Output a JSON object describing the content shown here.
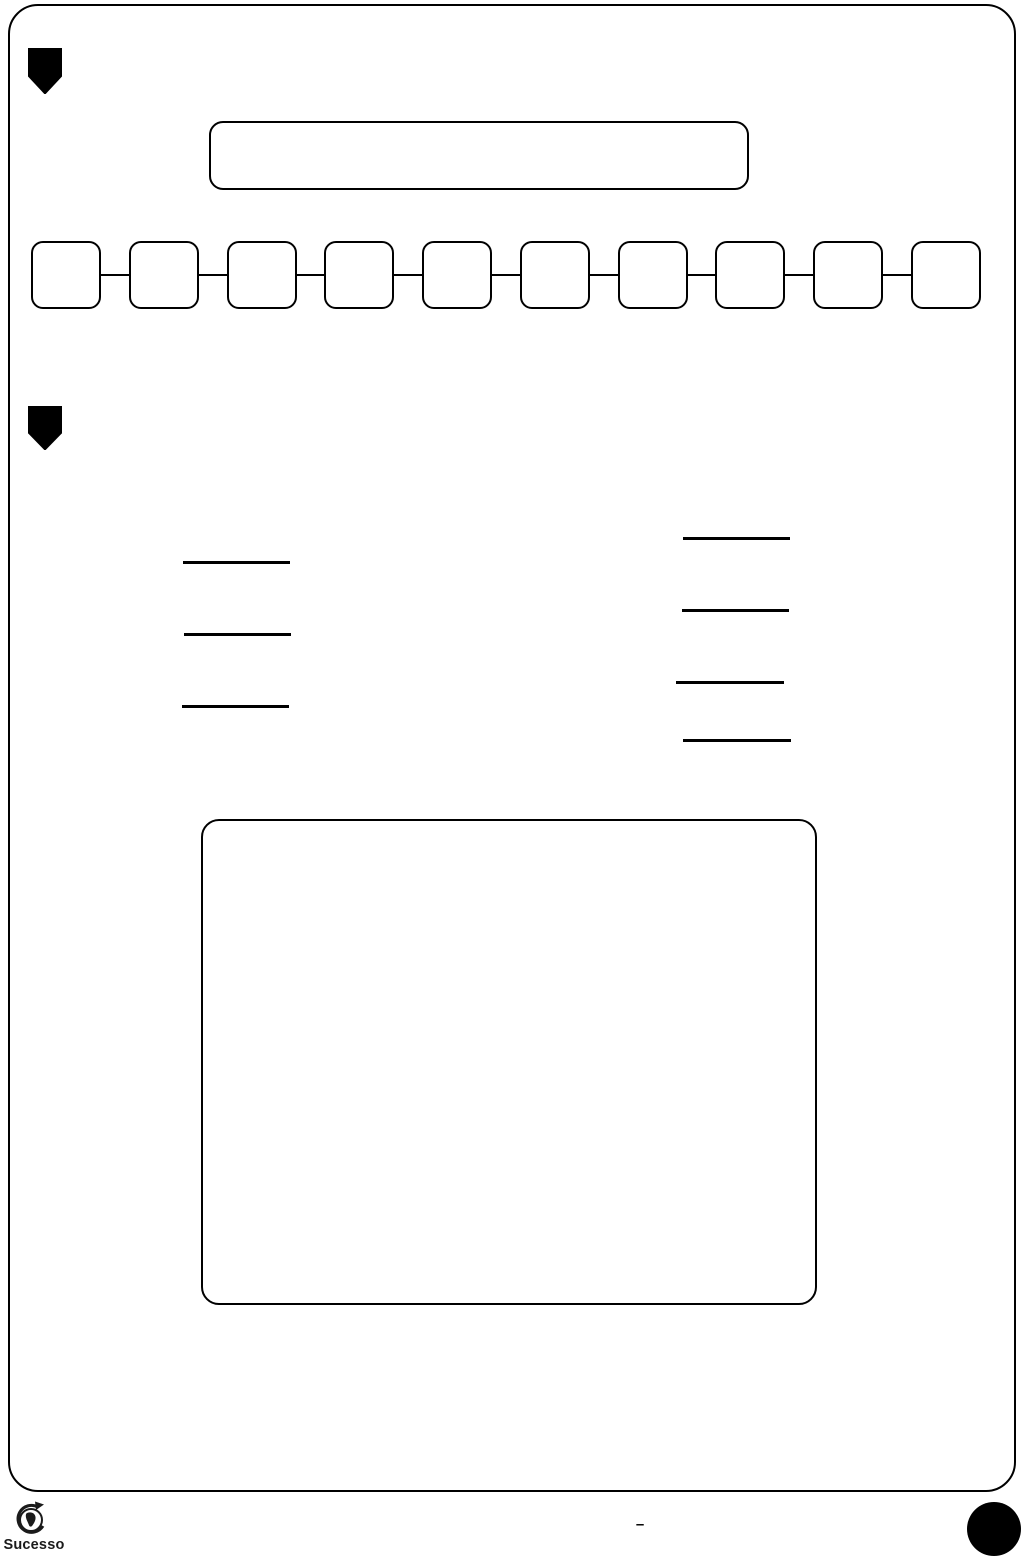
{
  "colors": {
    "ink": "#000000",
    "paper": "#ffffff",
    "logo_text": "#1b1b1b"
  },
  "section_top": {
    "badge_icon": "shield-icon",
    "title_box_value": ""
  },
  "sequence_row": {
    "count": 10,
    "values": [
      "",
      "",
      "",
      "",
      "",
      "",
      "",
      "",
      "",
      ""
    ]
  },
  "section_two": {
    "badge_icon": "shield-icon",
    "left_blank_count": 3,
    "right_blank_count": 4,
    "blank_values": [
      "",
      "",
      "",
      "",
      "",
      "",
      ""
    ],
    "answer_box_value": ""
  },
  "footer": {
    "brand": "Sucesso",
    "logo_icon": "globe-swoosh-icon",
    "page_separator": "–"
  }
}
